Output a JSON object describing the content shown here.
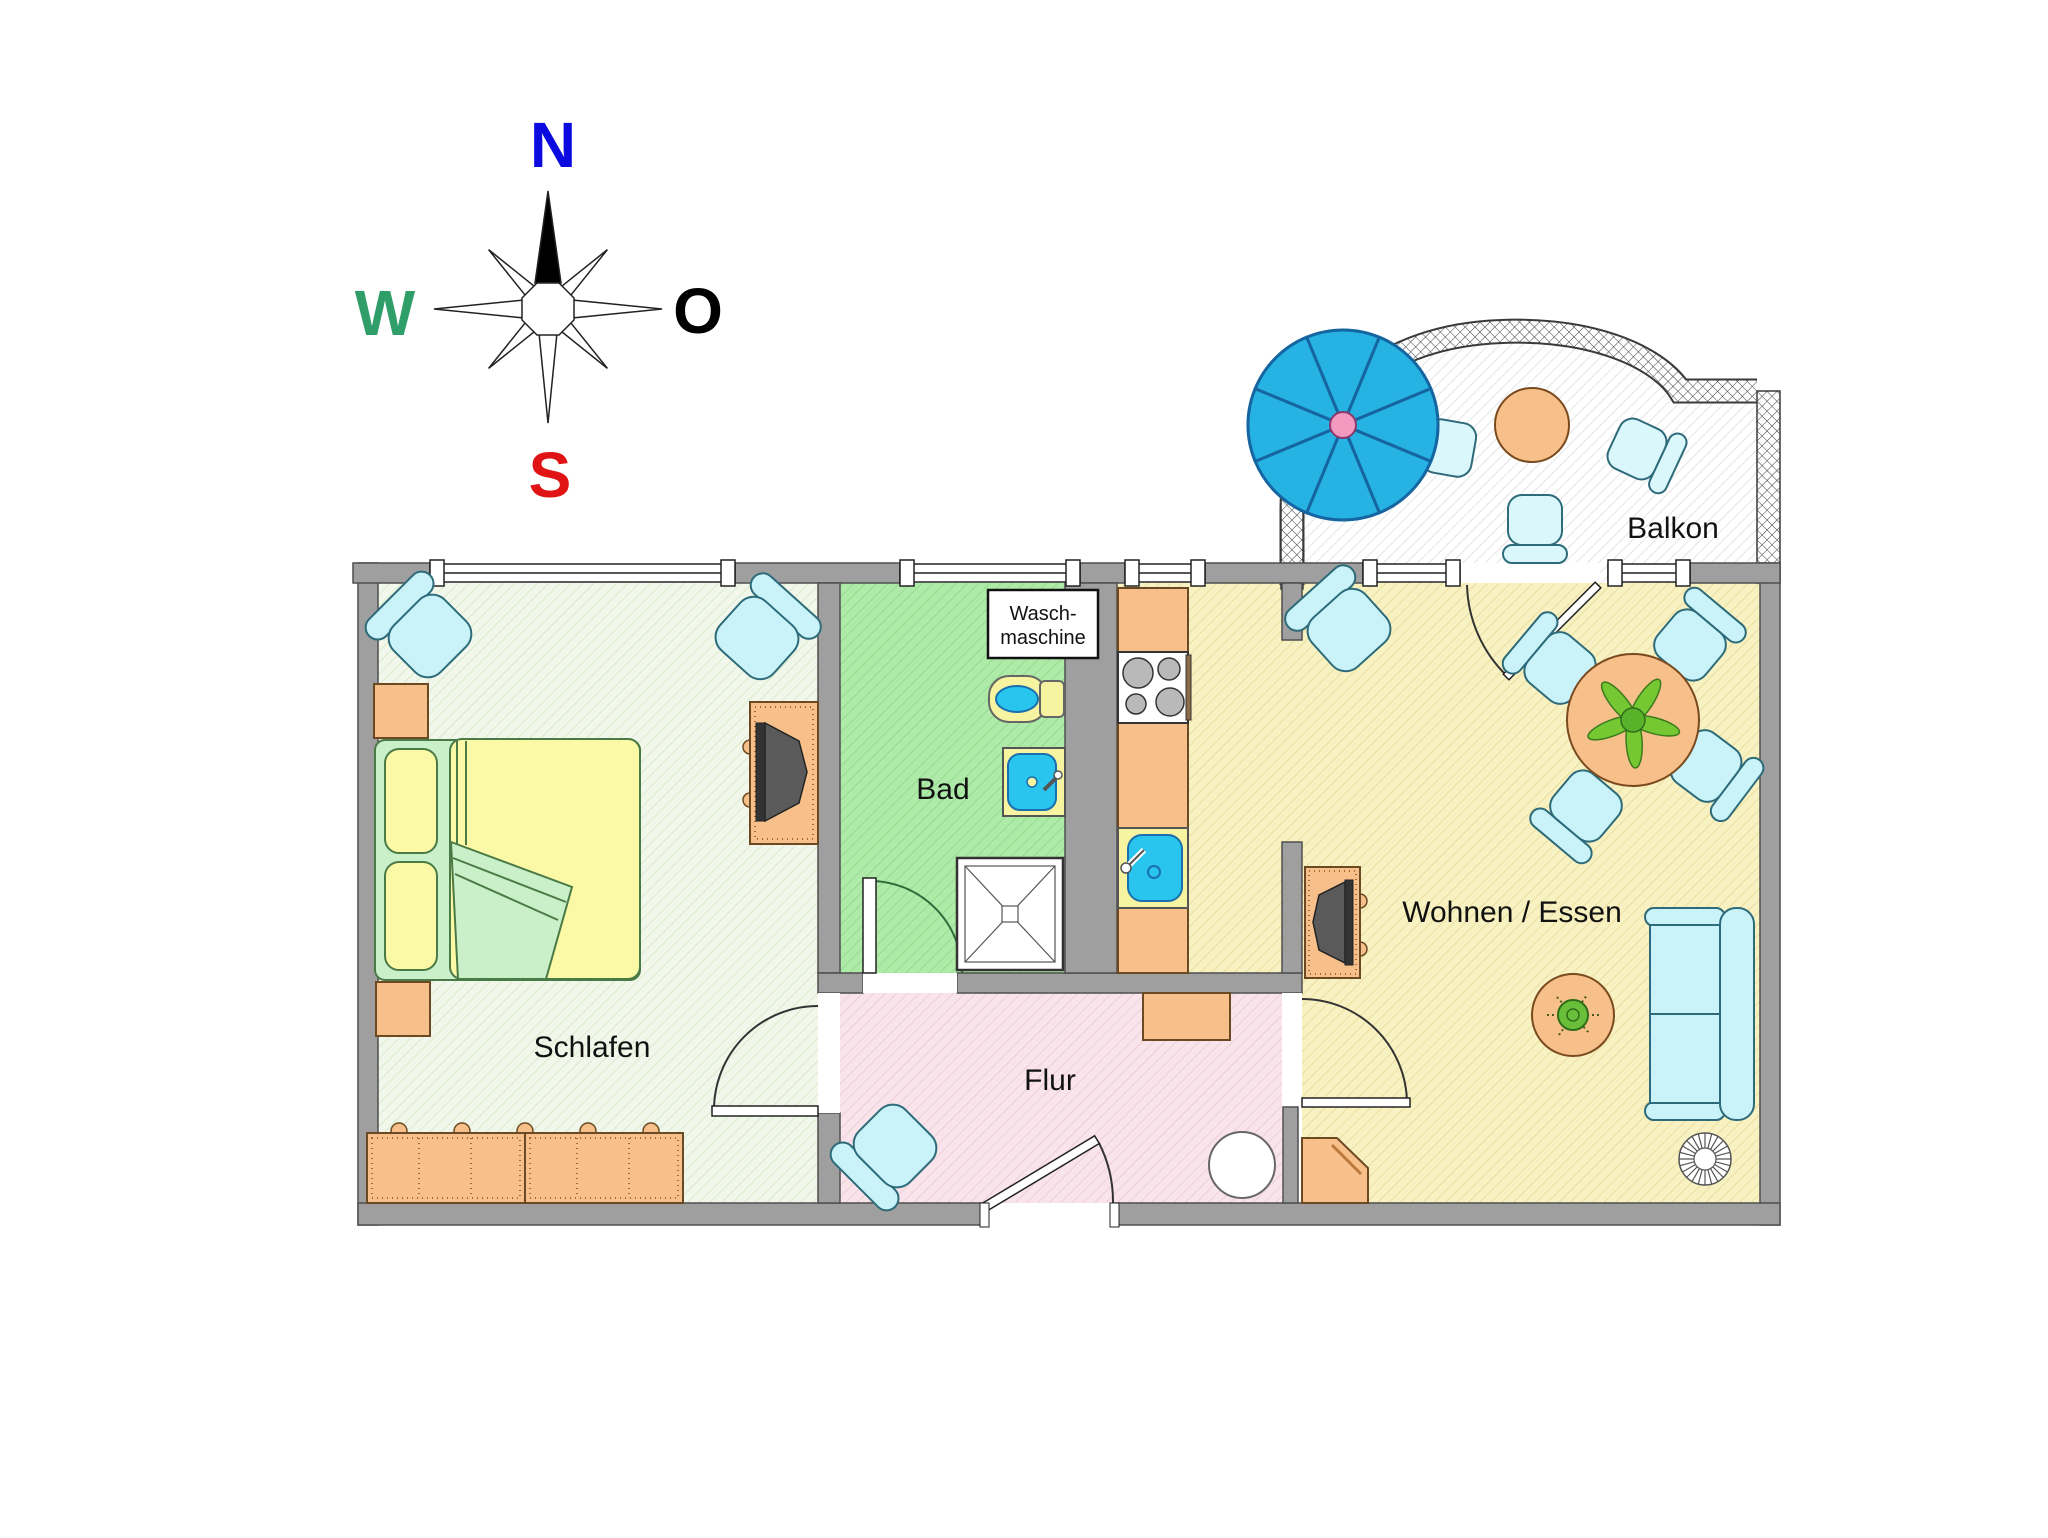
{
  "compass": {
    "n": "N",
    "w": "W",
    "o": "O",
    "s": "S"
  },
  "labels": {
    "schlafen": "Schlafen",
    "bad": "Bad",
    "flur": "Flur",
    "wohnen": "Wohnen / Essen",
    "balkon": "Balkon",
    "waschmaschine_line1": "Wasch-",
    "waschmaschine_line2": "maschine"
  },
  "colors": {
    "compass_n": "#0b0be0",
    "compass_w": "#2f9e68",
    "compass_o": "#000000",
    "compass_s": "#e01414",
    "wall": "#9f9f9f",
    "schlafen_floor": "#f1f7ea",
    "bad_floor": "#aeeaa8",
    "flur_floor": "#f8e4ea",
    "wohnen_floor": "#f8f1c2",
    "balkon_floor": "#ffffff",
    "furniture_orange": "#f7c08a",
    "seating_blue": "#c9f3f9",
    "bed_yellow": "#fbf9a6",
    "bed_green": "#c9f0c9",
    "water_blue": "#29c5ee",
    "umbrella_blue": "#27b2e4",
    "umbrella_center": "#f49ac1",
    "plant_green": "#76c832"
  }
}
